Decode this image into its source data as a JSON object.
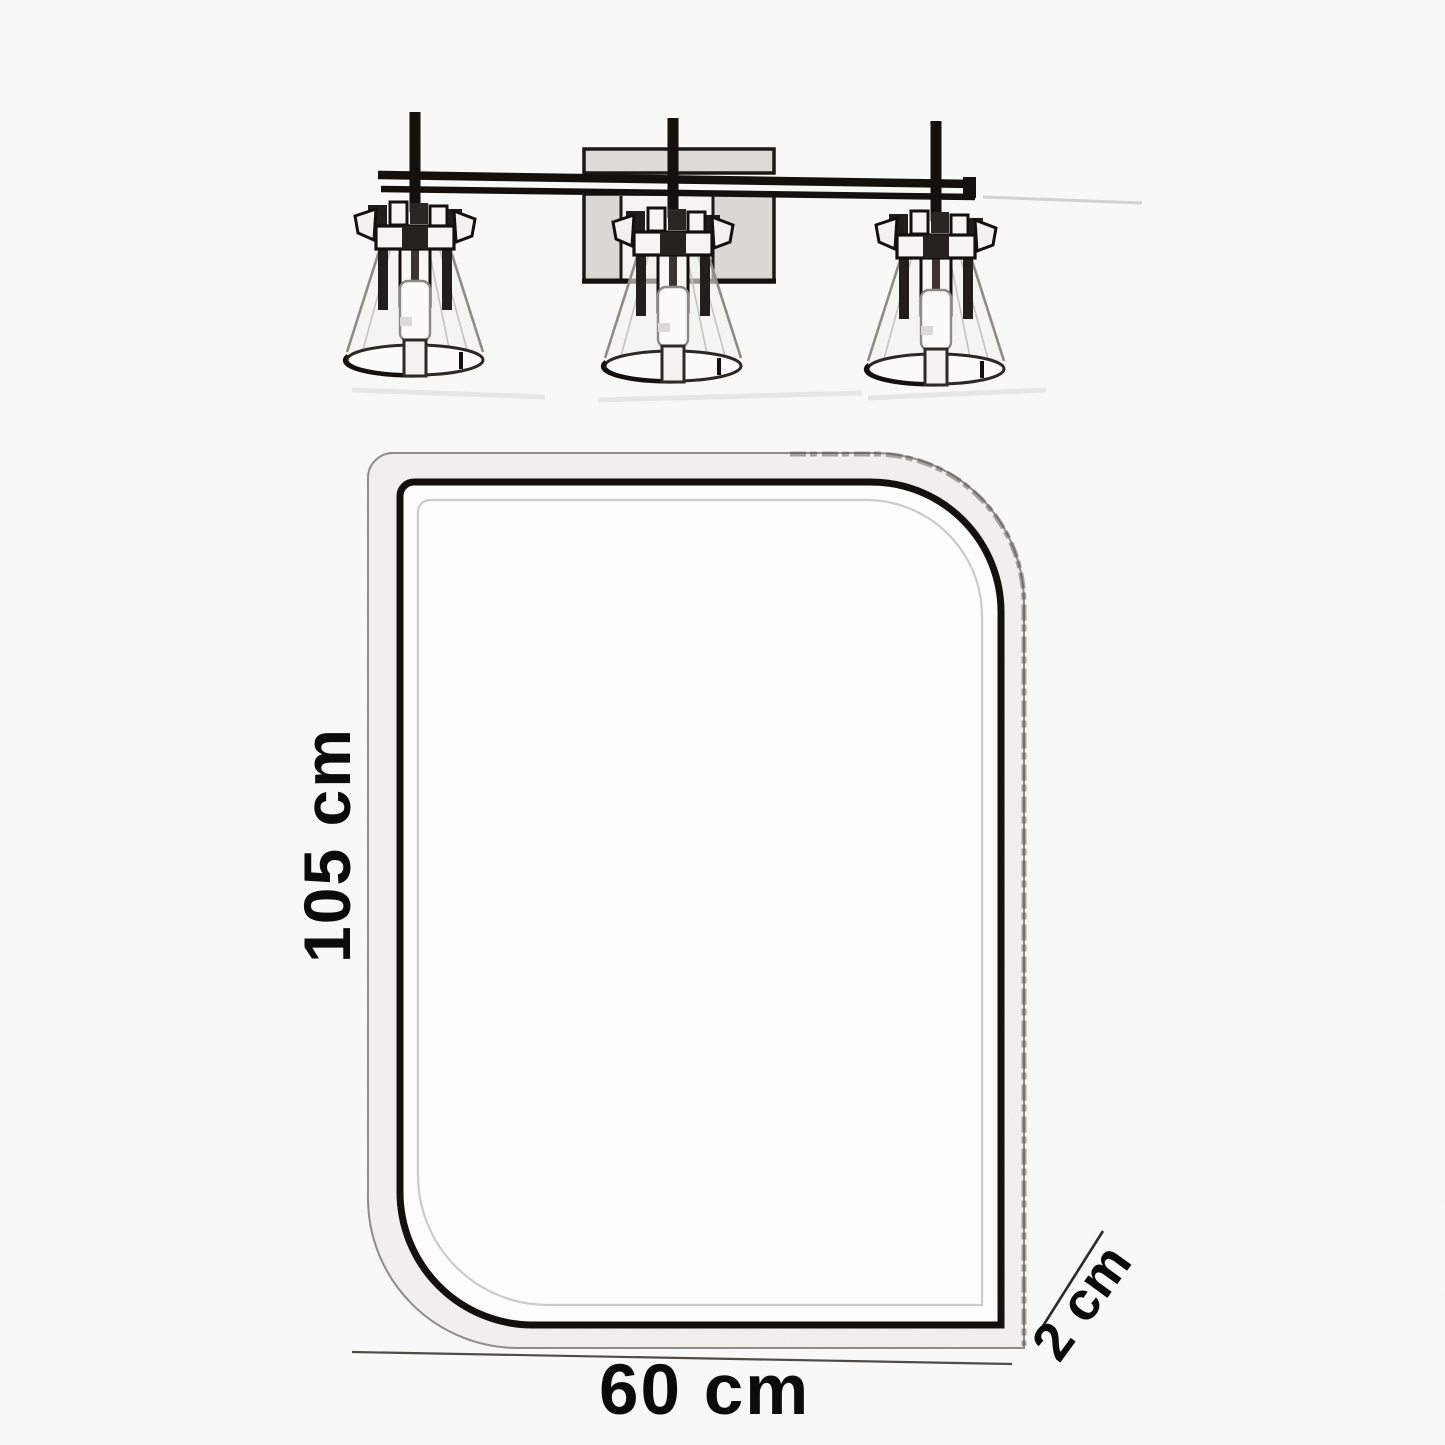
{
  "diagram": {
    "kind": "product-dimension-sketch",
    "subject": "Bathroom mirror with three-light vanity fixture (pencil sketch)",
    "colors": {
      "paper": "#f8f8f6",
      "ink": "#14110d",
      "shade_gray": "#d9d8d3",
      "cone_line": "#8f8c86"
    },
    "fixture": {
      "light_count": 3
    },
    "dimensions": {
      "height": {
        "label": "105 cm"
      },
      "width": {
        "label": "60 cm"
      },
      "depth": {
        "label": "2 cm"
      }
    }
  }
}
